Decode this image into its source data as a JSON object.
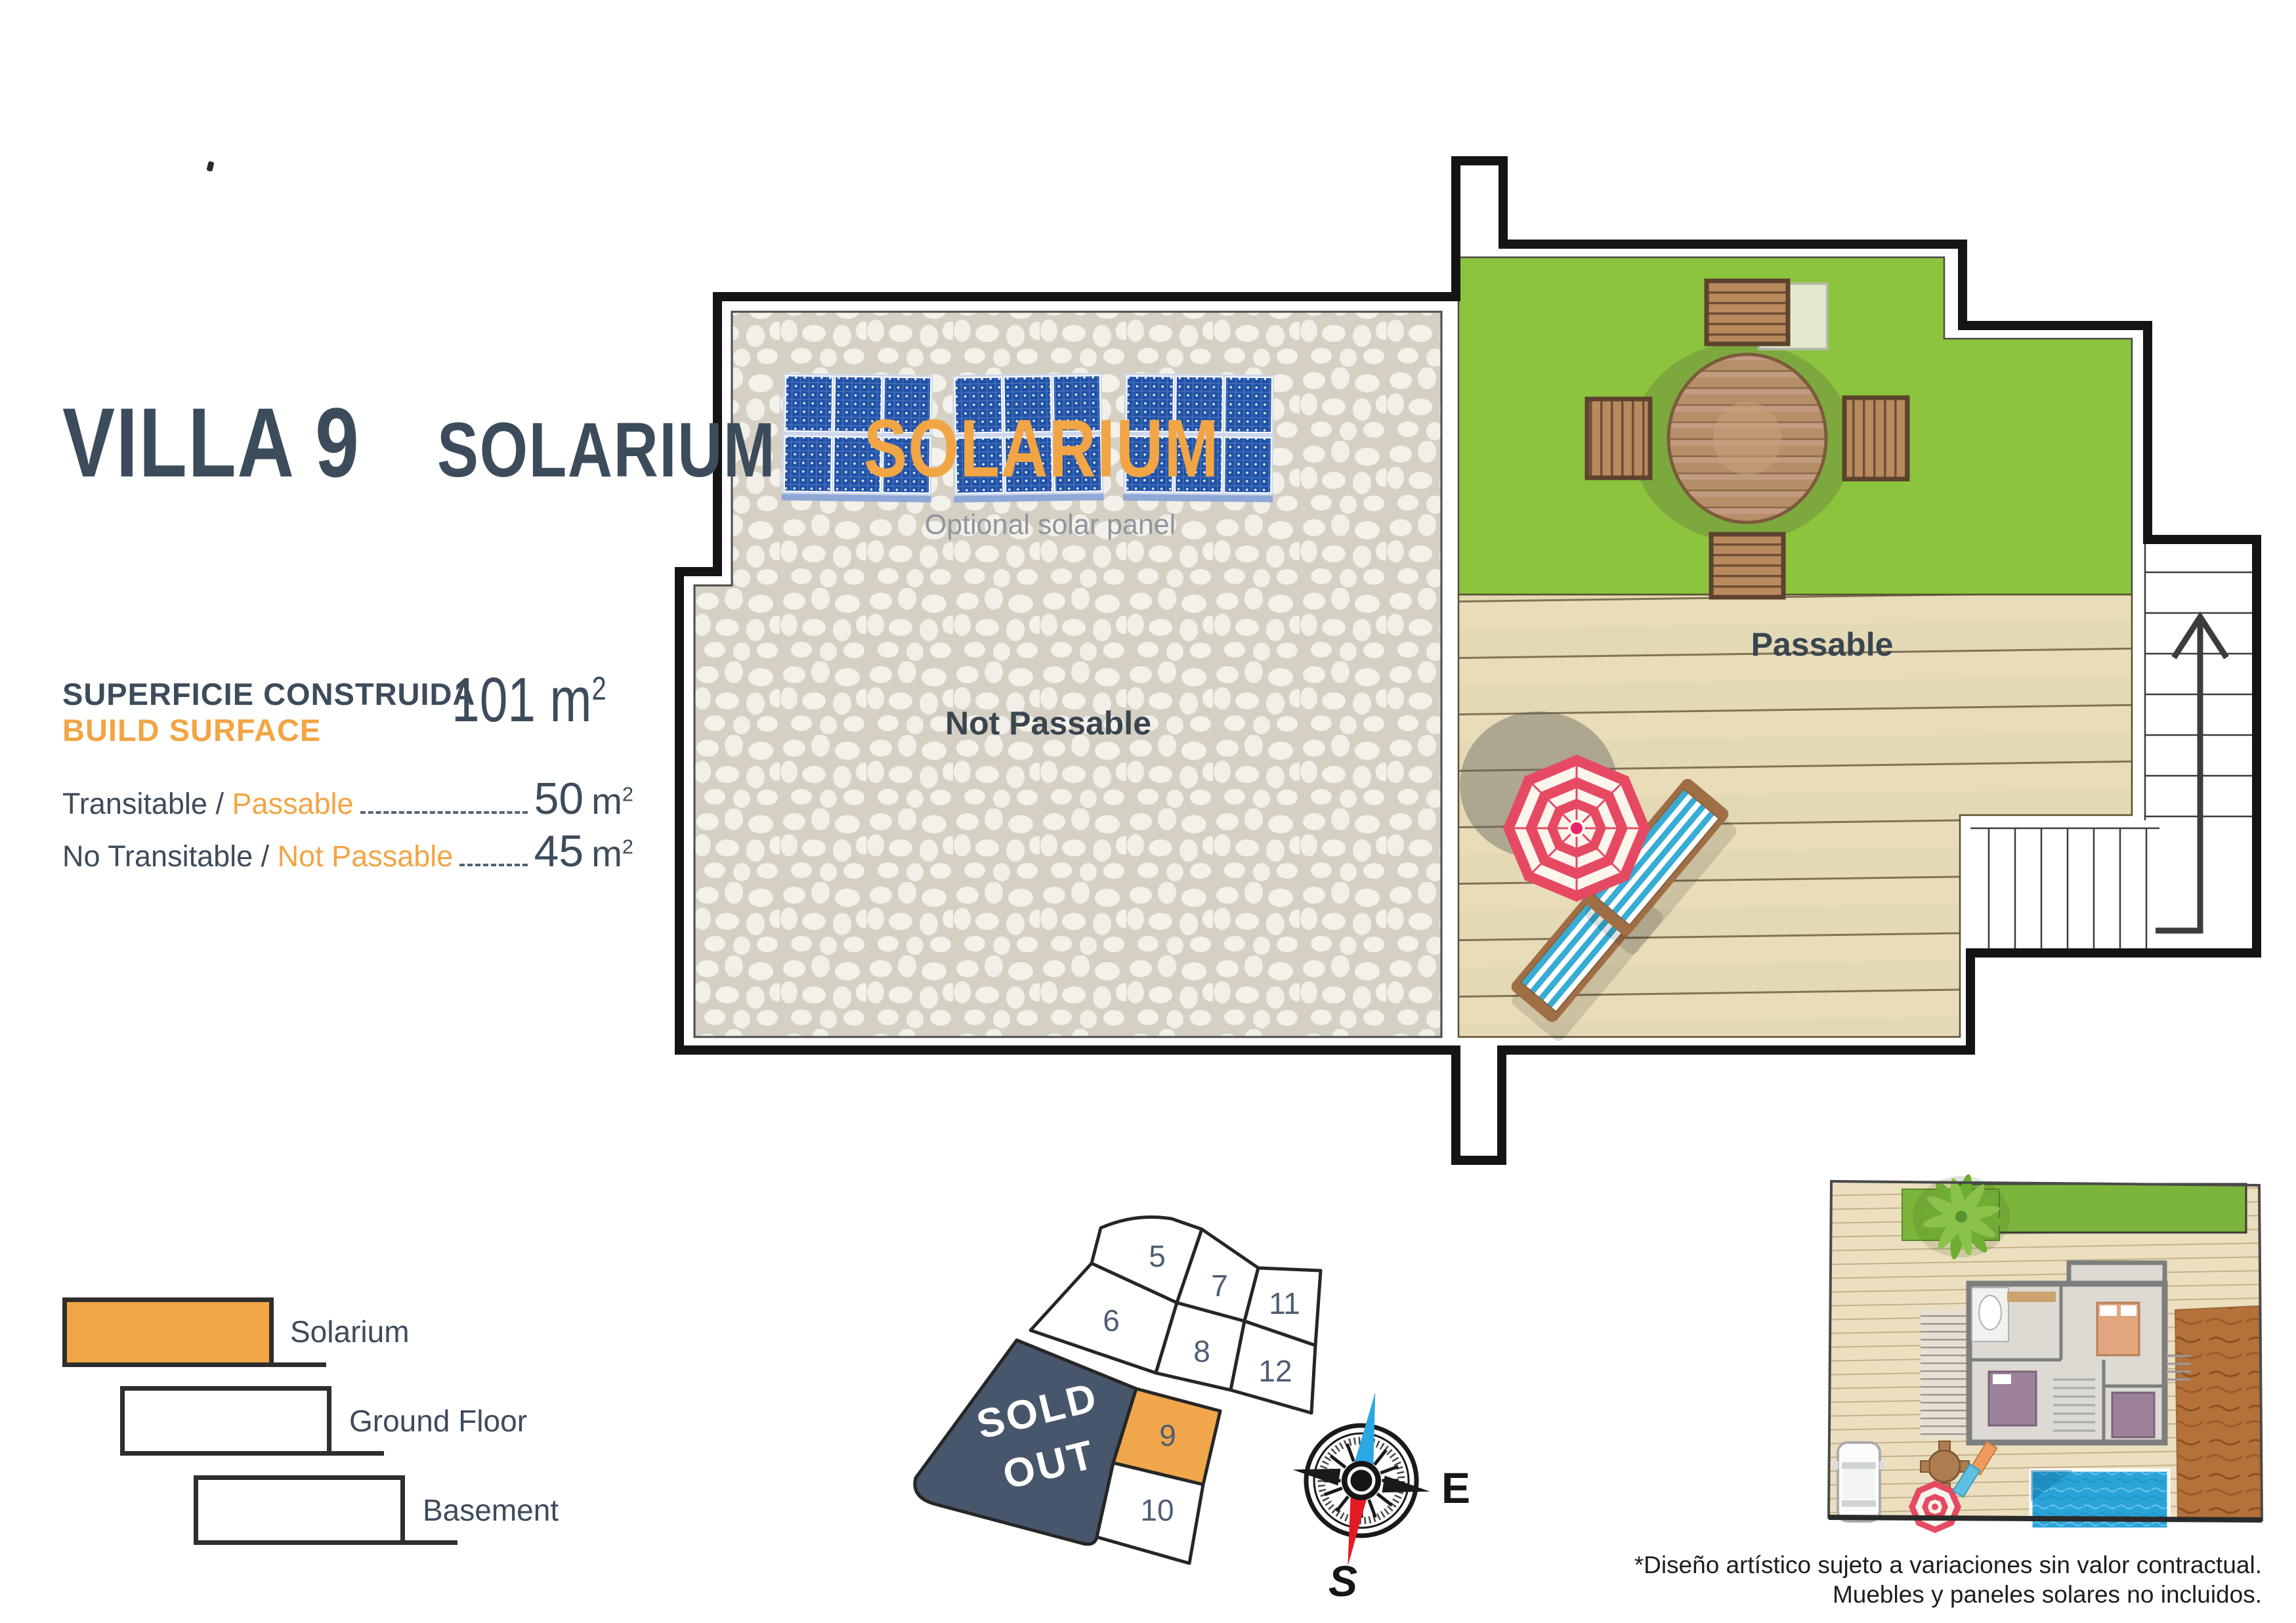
{
  "panel": {
    "title": "VILLA 9",
    "subtitle_primary": "SOLARIUM",
    "subtitle_accent": "SOLARIUM",
    "surface_label_line1": "SUPERFICIE CONSTRUIDA",
    "surface_label_line2": "BUILD SURFACE",
    "surface_value": "101",
    "surface_unit_base": "m",
    "surface_unit_sup": "2",
    "metrics": [
      {
        "label_dark": "Transitable / ",
        "label_accent": "Passable",
        "value": "50",
        "unit_base": "m",
        "unit_sup": "2"
      },
      {
        "label_dark": "No Transitable / ",
        "label_accent": "Not Passable",
        "value": "45",
        "unit_base": "m",
        "unit_sup": "2"
      }
    ],
    "legend": [
      {
        "label": "Solarium",
        "fill": "#F0A546"
      },
      {
        "label": "Ground Floor",
        "fill": "#FFFFFF"
      },
      {
        "label": "Basement",
        "fill": "#FFFFFF"
      }
    ]
  },
  "plan": {
    "optional_solar_panel": "Optional solar panel",
    "not_passable": "Not Passable",
    "passable": "Passable"
  },
  "lot_map": {
    "sold_out_lines": [
      "SOLD",
      "OUT"
    ],
    "sold_out_color": "#47566B",
    "highlight_color": "#F0A74B",
    "lots": [
      {
        "number": "5"
      },
      {
        "number": "7"
      },
      {
        "number": "11"
      },
      {
        "number": "6"
      },
      {
        "number": "8"
      },
      {
        "number": "12"
      },
      {
        "number": "9"
      },
      {
        "number": "10"
      }
    ],
    "highlighted_lot": "9"
  },
  "compass": {
    "east": "E",
    "south": "S"
  },
  "site_plan": {
    "disclaimer_line1": "*Diseño artístico sujeto a variaciones sin valor contractual.",
    "disclaimer_line2": "Muebles y paneles solares no incluidos."
  },
  "colors": {
    "dark_slate": "#3D4C5B",
    "accent_orange": "#F2A544",
    "grass_green": "#8CC43E",
    "deck_tan": "#E9DDB9",
    "panel_blue": "#2051A6"
  }
}
